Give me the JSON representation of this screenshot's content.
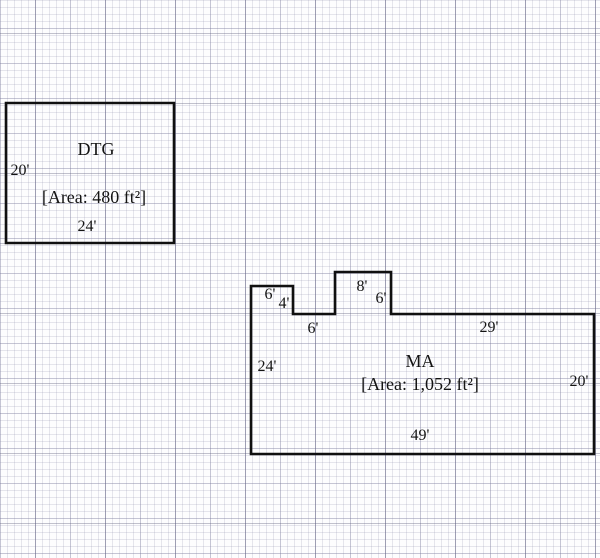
{
  "scale_px_per_ft": 7,
  "rooms": {
    "dtg": {
      "name": "DTG",
      "area_label": "[Area: 480 ft²]",
      "vertices_ft": [
        [
          0,
          0
        ],
        [
          24,
          0
        ],
        [
          24,
          20
        ],
        [
          0,
          20
        ]
      ],
      "dims": {
        "left": "20'",
        "bottom": "24'"
      }
    },
    "ma": {
      "name": "MA",
      "area_label": "[Area: 1,052 ft²]",
      "vertices_ft": [
        [
          0,
          2
        ],
        [
          6,
          2
        ],
        [
          6,
          6
        ],
        [
          12,
          6
        ],
        [
          12,
          0
        ],
        [
          20,
          0
        ],
        [
          20,
          6
        ],
        [
          49,
          6
        ],
        [
          49,
          26
        ],
        [
          0,
          26
        ]
      ],
      "dims": {
        "left": "24'",
        "bottom": "49'",
        "right": "20'",
        "top_right": "29'",
        "ledge_top": "6'",
        "ledge_side": "4'",
        "ledge_bottom": "6'",
        "bump_top": "8'",
        "bump_side": "6'"
      }
    }
  }
}
